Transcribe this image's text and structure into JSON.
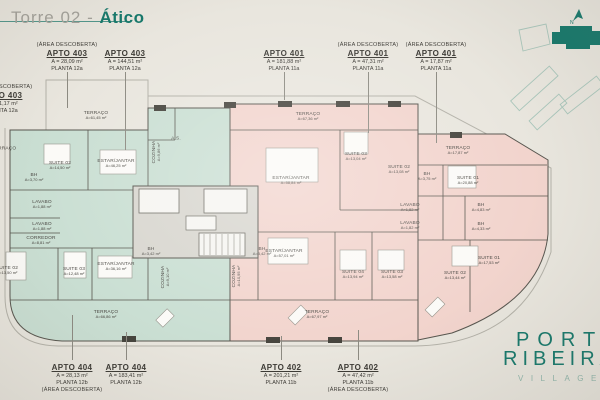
{
  "header": {
    "title_prefix": "Torre 02 - ",
    "title_highlight": "Ático"
  },
  "logo": {
    "line1": "PORTO",
    "line2": "RIBEIRA",
    "line3": "VILLAGE"
  },
  "keyplan": {
    "north_label": "N"
  },
  "colors": {
    "teal": "#16786b",
    "teal_light": "#92b7ac",
    "background": "#e9e6de",
    "green_unit": "#cadfd3",
    "pink_unit": "#f2d4cd",
    "core_gray": "#d8d6cf",
    "wall": "#57554e",
    "boundary": "#b3b1a8",
    "text": "#3c3a35"
  },
  "callouts": {
    "top": [
      {
        "pre": "(ÁREA DESCOBERTA)",
        "apto": "APTO 403",
        "area": "A = 28,09 m²",
        "planta": "PLANTA 12a",
        "x": 67,
        "leader": [
          72,
          108
        ]
      },
      {
        "pre": "",
        "apto": "APTO 403",
        "area": "A = 144,51 m²",
        "planta": "PLANTA 12a",
        "x": 125,
        "leader": [
          72,
          150
        ]
      },
      {
        "pre": "",
        "apto": "APTO 401",
        "area": "A = 181,88 m²",
        "planta": "PLANTA 11a",
        "x": 284,
        "leader": [
          72,
          100
        ]
      },
      {
        "pre": "(ÁREA DESCOBERTA)",
        "apto": "APTO 401",
        "area": "A = 47,31 m²",
        "planta": "PLANTA 11a",
        "x": 368,
        "leader": [
          72,
          133
        ]
      },
      {
        "pre": "(ÁREA DESCOBERTA)",
        "apto": "APTO 401",
        "area": "A = 17,87 m²",
        "planta": "PLANTA 11a",
        "x": 436,
        "leader": [
          72,
          143
        ]
      }
    ],
    "bottom": [
      {
        "apto": "APTO 404",
        "area": "A = 28,13 m²",
        "planta": "PLANTA 12b",
        "post": "(ÁREA DESCOBERTA)",
        "x": 72,
        "leader": [
          315,
          360
        ]
      },
      {
        "apto": "APTO 404",
        "area": "A = 183,41 m²",
        "planta": "PLANTA 12b",
        "post": "",
        "x": 126,
        "leader": [
          332,
          360
        ]
      },
      {
        "apto": "APTO 402",
        "area": "A = 201,21 m²",
        "planta": "PLANTA 11b",
        "post": "",
        "x": 281,
        "leader": [
          336,
          360
        ]
      },
      {
        "apto": "APTO 402",
        "area": "A = 47,42 m²",
        "planta": "PLANTA 11b",
        "post": "(ÁREA DESCOBERTA)",
        "x": 358,
        "leader": [
          330,
          360
        ]
      }
    ],
    "left": {
      "pre": "(ÁREA DESCOBERTA)",
      "apto": "APTO 403",
      "area": "A = 41,17 m²",
      "planta": "PLANTA 12a",
      "x": 2,
      "y": 84
    }
  },
  "plan": {
    "rooms": [
      {
        "l": "TERRAÇO",
        "a": "A=61,45 m²",
        "x": 96,
        "y": 116
      },
      {
        "l": "TERRAÇO",
        "a": "",
        "x": 4,
        "y": 149
      },
      {
        "l": "SUITE 02",
        "a": "A=14,50 m²",
        "x": 60,
        "y": 166
      },
      {
        "l": "BH",
        "a": "A=3,70 m²",
        "x": 34,
        "y": 178
      },
      {
        "l": "ESTAR/JANTAR",
        "a": "A=46,25 m²",
        "x": 116,
        "y": 164
      },
      {
        "l": "COZINHA",
        "a": "A=9,86 m²",
        "x": 157,
        "y": 152,
        "v": true
      },
      {
        "l": "A.S.",
        "a": "",
        "x": 176,
        "y": 139
      },
      {
        "l": "LAVABO",
        "a": "A=1,88 m²",
        "x": 42,
        "y": 205
      },
      {
        "l": "LAVABO",
        "a": "A=1,88 m²",
        "x": 42,
        "y": 227
      },
      {
        "l": "CORREDOR",
        "a": "A=8,81 m²",
        "x": 41,
        "y": 241
      },
      {
        "l": "SUITE 02",
        "a": "A=13,50 m²",
        "x": 7,
        "y": 271
      },
      {
        "l": "SUITE 03",
        "a": "A=12,48 m²",
        "x": 74,
        "y": 272
      },
      {
        "l": "ESTAR/JANTAR",
        "a": "A=36,16 m²",
        "x": 116,
        "y": 267
      },
      {
        "l": "COZINHA",
        "a": "A=9,10 m²",
        "x": 166,
        "y": 277,
        "v": true
      },
      {
        "l": "BH",
        "a": "A=3,42 m²",
        "x": 151,
        "y": 252
      },
      {
        "l": "TERRAÇO",
        "a": "A=66,86 m²",
        "x": 106,
        "y": 315
      },
      {
        "l": "TERRAÇO",
        "a": "A=67,36 m²",
        "x": 308,
        "y": 117
      },
      {
        "l": "ESTAR/JANTAR",
        "a": "A=58,84 m²",
        "x": 291,
        "y": 181
      },
      {
        "l": "SUITE 03",
        "a": "A=13,04 m²",
        "x": 356,
        "y": 157
      },
      {
        "l": "COZINHA",
        "a": "A=10,95 m²",
        "x": 237,
        "y": 276,
        "v": true
      },
      {
        "l": "BH",
        "a": "A=3,42 m²",
        "x": 262,
        "y": 252
      },
      {
        "l": "ESTAR/JANTAR",
        "a": "A=57,01 m²",
        "x": 284,
        "y": 254
      },
      {
        "l": "SUITE 04",
        "a": "A=13,94 m²",
        "x": 353,
        "y": 275
      },
      {
        "l": "SUITE 03",
        "a": "A=13,58 m²",
        "x": 392,
        "y": 275
      },
      {
        "l": "TERRAÇO",
        "a": "A=67,97 m²",
        "x": 317,
        "y": 315
      },
      {
        "l": "TERRAÇO",
        "a": "A=17,87 m²",
        "x": 458,
        "y": 151
      },
      {
        "l": "SUITE 02",
        "a": "A=13,08 m²",
        "x": 399,
        "y": 170
      },
      {
        "l": "BH",
        "a": "A=3,75 m²",
        "x": 427,
        "y": 177
      },
      {
        "l": "SUITE 01",
        "a": "A=20,88 m²",
        "x": 468,
        "y": 181
      },
      {
        "l": "LAVABO",
        "a": "A=1,82 m²",
        "x": 410,
        "y": 208
      },
      {
        "l": "LAVABO",
        "a": "A=1,82 m²",
        "x": 410,
        "y": 226
      },
      {
        "l": "BH",
        "a": "A=4,83 m²",
        "x": 481,
        "y": 208
      },
      {
        "l": "BH",
        "a": "A=4,33 m²",
        "x": 481,
        "y": 227
      },
      {
        "l": "SUITE 01",
        "a": "A=17,53 m²",
        "x": 489,
        "y": 261
      },
      {
        "l": "SUITE 02",
        "a": "A=13,44 m²",
        "x": 455,
        "y": 276
      }
    ]
  }
}
